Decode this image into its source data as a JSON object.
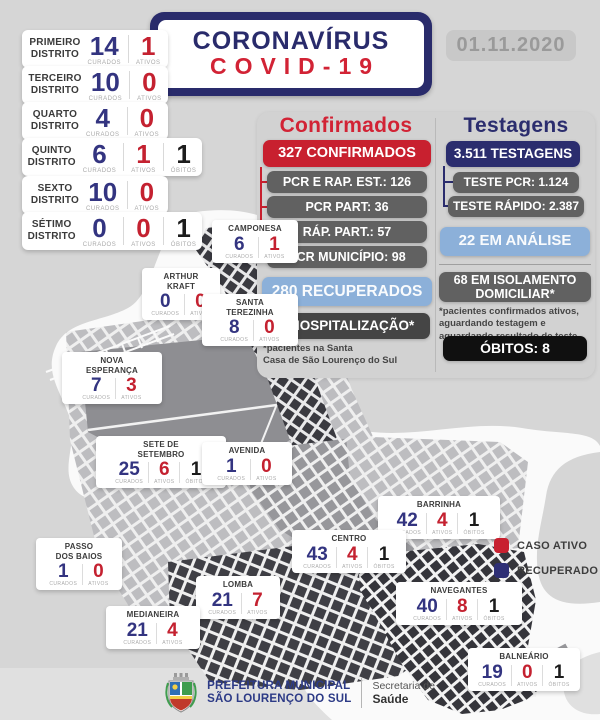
{
  "header": {
    "title_line1": "CORONAVÍRUS",
    "title_line2": "COVID-19",
    "date": "01.11.2020"
  },
  "labels": {
    "curados": "CURADOS",
    "ativos": "ATIVOS",
    "obitos": "ÓBITOS"
  },
  "districts": [
    {
      "name": "PRIMEIRO\nDISTRITO",
      "curados": "14",
      "ativos": "1"
    },
    {
      "name": "TERCEIRO\nDISTRITO",
      "curados": "10",
      "ativos": "0"
    },
    {
      "name": "QUARTO\nDISTRITO",
      "curados": "4",
      "ativos": "0"
    },
    {
      "name": "QUINTO\nDISTRITO",
      "curados": "6",
      "ativos": "1",
      "obitos": "1"
    },
    {
      "name": "SEXTO\nDISTRITO",
      "curados": "10",
      "ativos": "0"
    },
    {
      "name": "SÉTIMO\nDISTRITO",
      "curados": "0",
      "ativos": "0",
      "obitos": "1"
    }
  ],
  "confirmados": {
    "title": "Confirmados",
    "total": "327 CONFIRMADOS",
    "breakdown": [
      "PCR E RAP. EST.: 126",
      "PCR PART: 36",
      "RÁP. PART.: 57",
      "PCR MUNICÍPIO: 98"
    ],
    "recuperados": "280 RECUPERADOS",
    "hospitalizacao": "3 HOSPITALIZAÇÃO*",
    "note": "*pacientes na Santa\nCasa de São Lourenço do Sul"
  },
  "testagens": {
    "title": "Testagens",
    "total": "3.511 TESTAGENS",
    "breakdown": [
      "TESTE PCR: 1.124",
      "TESTE RÁPIDO: 2.387"
    ],
    "analise": "22 EM ANÁLISE",
    "isolamento": "68 EM ISOLAMENTO\nDOMICILIAR*",
    "note": "*pacientes confirmados ativos,\naguardando testagem e\naguardando resultado de teste",
    "obitos": "ÓBITOS: 8"
  },
  "neighborhoods": [
    {
      "name": "CAMPONESA",
      "curados": "6",
      "ativos": "1"
    },
    {
      "name": "ARTHUR\nKRAFT",
      "curados": "0",
      "ativos": "0"
    },
    {
      "name": "SANTA\nTEREZINHA",
      "curados": "8",
      "ativos": "0"
    },
    {
      "name": "NOVA\nESPERANÇA",
      "curados": "7",
      "ativos": "3"
    },
    {
      "name": "SETE DE\nSETEMBRO",
      "curados": "25",
      "ativos": "6",
      "obitos": "1"
    },
    {
      "name": "AVENIDA",
      "curados": "1",
      "ativos": "0"
    },
    {
      "name": "PASSO\nDOS BAIOS",
      "curados": "1",
      "ativos": "0"
    },
    {
      "name": "BARRINHA",
      "curados": "42",
      "ativos": "4",
      "obitos": "1"
    },
    {
      "name": "CENTRO",
      "curados": "43",
      "ativos": "4",
      "obitos": "1"
    },
    {
      "name": "LOMBA",
      "curados": "21",
      "ativos": "7"
    },
    {
      "name": "MEDIANEIRA",
      "curados": "21",
      "ativos": "4"
    },
    {
      "name": "NAVEGANTES",
      "curados": "40",
      "ativos": "8",
      "obitos": "1"
    },
    {
      "name": "BALNEÁRIO",
      "curados": "19",
      "ativos": "0",
      "obitos": "1"
    }
  ],
  "legend": [
    {
      "label": "CASO ATIVO",
      "color": "#c8202f"
    },
    {
      "label": "RECUPERADO",
      "color": "#2e2f75"
    }
  ],
  "footer": {
    "org_line1": "PREFEITURA MUNICIPAL",
    "org_line2": "SÃO LOURENÇO DO SUL",
    "dept_line1": "Secretaria de",
    "dept_line2": "Saúde"
  },
  "colors": {
    "navy": "#2b2d6e",
    "red": "#c8202f",
    "light_blue": "#8cb0d9",
    "box_gray": "#616161",
    "dark_box": "#454545",
    "black_box": "#101010",
    "page_bg": "#d6d6d6",
    "card_white": "#ffffff"
  }
}
